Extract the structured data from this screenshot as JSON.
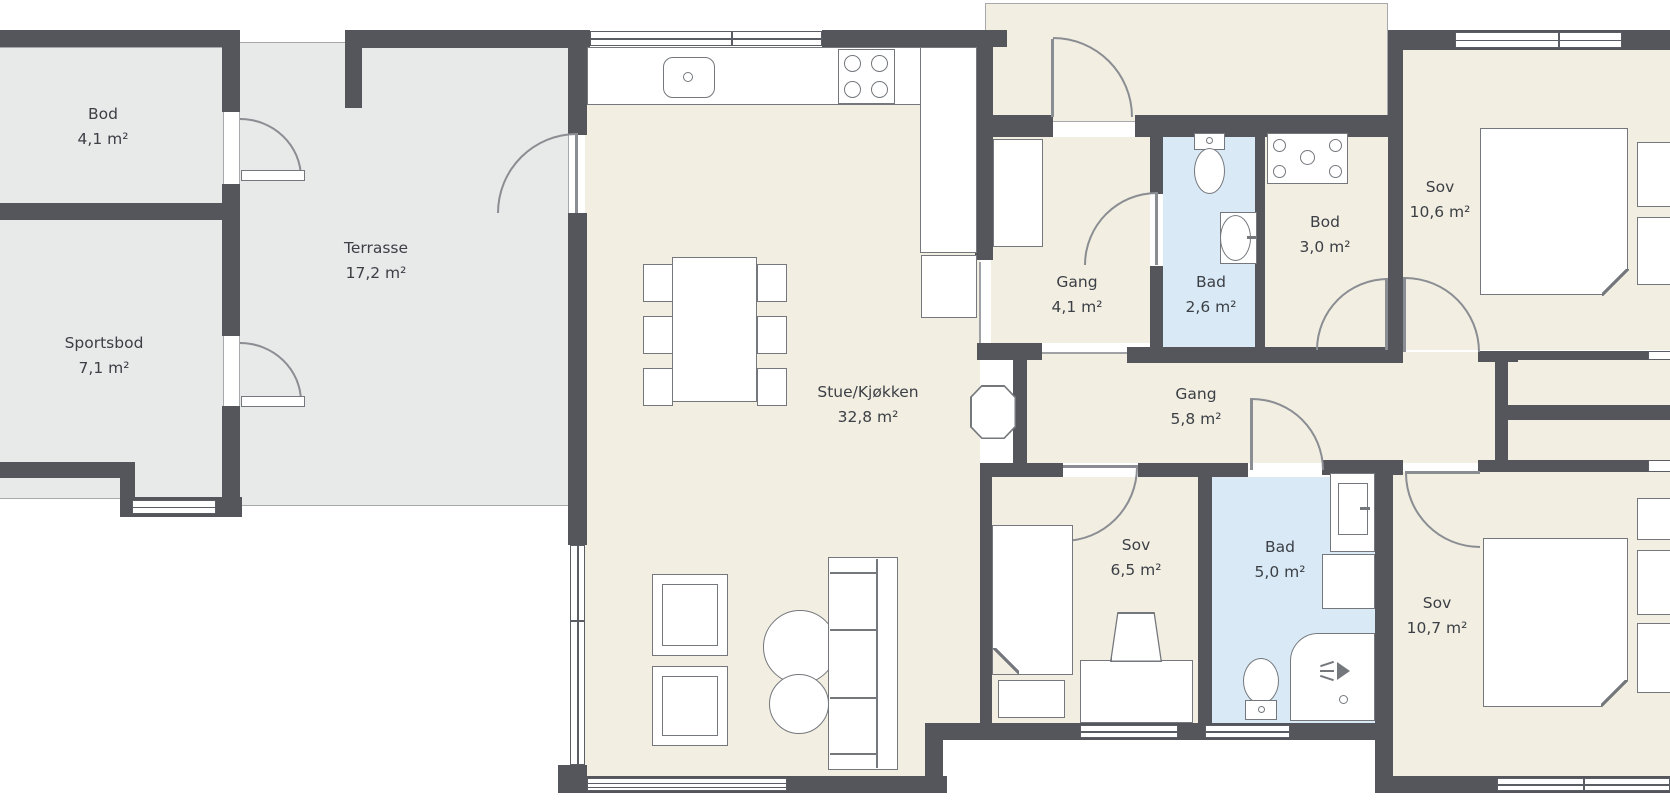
{
  "plan_title": "Floor plan (Norwegian bungalow)",
  "palette": {
    "wall": "#54565c",
    "interior_floor": "#f2eee2",
    "outdoor_floor": "#e8e9e9",
    "bathroom_floor": "#d9eaf6",
    "fixture_stroke": "#74777c",
    "text": "#3c4046"
  },
  "rooms": [
    {
      "id": "bod-ute",
      "name": "Bod",
      "area": "4,1 m²"
    },
    {
      "id": "sportsbod",
      "name": "Sportsbod",
      "area": "7,1 m²"
    },
    {
      "id": "terrasse",
      "name": "Terrasse",
      "area": "17,2 m²"
    },
    {
      "id": "stue-kjokken",
      "name": "Stue/Kjøkken",
      "area": "32,8 m²"
    },
    {
      "id": "gang-entre",
      "name": "Gang",
      "area": "4,1 m²"
    },
    {
      "id": "bad-liten",
      "name": "Bad",
      "area": "2,6 m²"
    },
    {
      "id": "bod-inne",
      "name": "Bod",
      "area": "3,0 m²"
    },
    {
      "id": "sov-1",
      "name": "Sov",
      "area": "10,6 m²"
    },
    {
      "id": "gang-midt",
      "name": "Gang",
      "area": "5,8 m²"
    },
    {
      "id": "sov-2",
      "name": "Sov",
      "area": "6,5 m²"
    },
    {
      "id": "bad-stor",
      "name": "Bad",
      "area": "5,0 m²"
    },
    {
      "id": "sov-3",
      "name": "Sov",
      "area": "10,7 m²"
    }
  ],
  "fixtures": [
    "kitchen-counter",
    "kitchen-sink",
    "cooktop-4-burners",
    "tall-cabinet-fridge",
    "dining-table-6-chairs",
    "armchair",
    "armchair",
    "coffee-table-round",
    "coffee-table-round",
    "sofa-3-seat",
    "wood-stove",
    "wardrobe-closet",
    "toilet",
    "wash-basin",
    "washing-machine",
    "double-bed",
    "single-bed",
    "nightstand",
    "desk",
    "desk-chair",
    "bathroom-vanity",
    "shower-cabin",
    "double-bed",
    "windows",
    "door-swings"
  ]
}
